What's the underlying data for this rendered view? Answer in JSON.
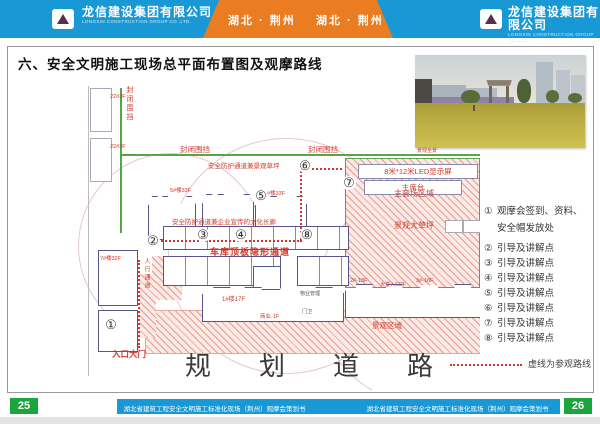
{
  "header": {
    "company_cn": "龙信建设集团有限公司",
    "company_en": "LONGXIN CONSTRUCTION GROUP CO.,LTD.",
    "region": "湖北 · 荆州",
    "colors": {
      "bar_blue": "#1898d5",
      "band_orange": "#ea7c22"
    }
  },
  "title": "六、安全文明施工现场总平面布置图及观摩路线",
  "photo": {
    "caption": "景观全景"
  },
  "plan": {
    "labels": {
      "enclosure": "封闭围挡",
      "lawn_corridor": "安全防护通道兼景观草坪",
      "culture_corridor": "安全防护通道兼企业宣传的文化长廊",
      "garage_passage": "车库顶板隐形通道",
      "led_screen": "8米*12米LED显示屏",
      "stage": "主席台",
      "venue_area": "主会场区域",
      "big_lawn": "景观大草坪",
      "landscape_area": "景观区域",
      "entrance_gate": "入口大门",
      "pedestrian": "人行通道",
      "road": "规划道路"
    },
    "buildings": {
      "b22": "22#3F",
      "b5": "5#楼33F",
      "b9": "9#楼33F",
      "b7": "7#楼32F",
      "b1": "1#楼17F",
      "commercial": "商业-1F",
      "b2": "2#-18F",
      "lobby": "大堂入口2F",
      "b3": "3#-18F",
      "property": "物业管理",
      "guard": "门卫"
    },
    "markers": [
      "①",
      "②",
      "③",
      "④",
      "⑤",
      "⑥",
      "⑦",
      "⑧"
    ]
  },
  "legend": {
    "items": [
      {
        "num": "①",
        "line1": "观摩会签到、资料、",
        "line2": "安全帽发放处"
      },
      {
        "num": "②",
        "line1": "引导及讲解点"
      },
      {
        "num": "③",
        "line1": "引导及讲解点"
      },
      {
        "num": "④",
        "line1": "引导及讲解点"
      },
      {
        "num": "⑤",
        "line1": "引导及讲解点"
      },
      {
        "num": "⑥",
        "line1": "引导及讲解点"
      },
      {
        "num": "⑦",
        "line1": "引导及讲解点"
      },
      {
        "num": "⑧",
        "line1": "引导及讲解点"
      }
    ],
    "route_note": "虚线为参观路线"
  },
  "footer": {
    "page_left": "25",
    "page_right": "26",
    "doc_title": "湖北省建筑工程安全文明施工标准化现场（荆州）观摩会策划书"
  }
}
